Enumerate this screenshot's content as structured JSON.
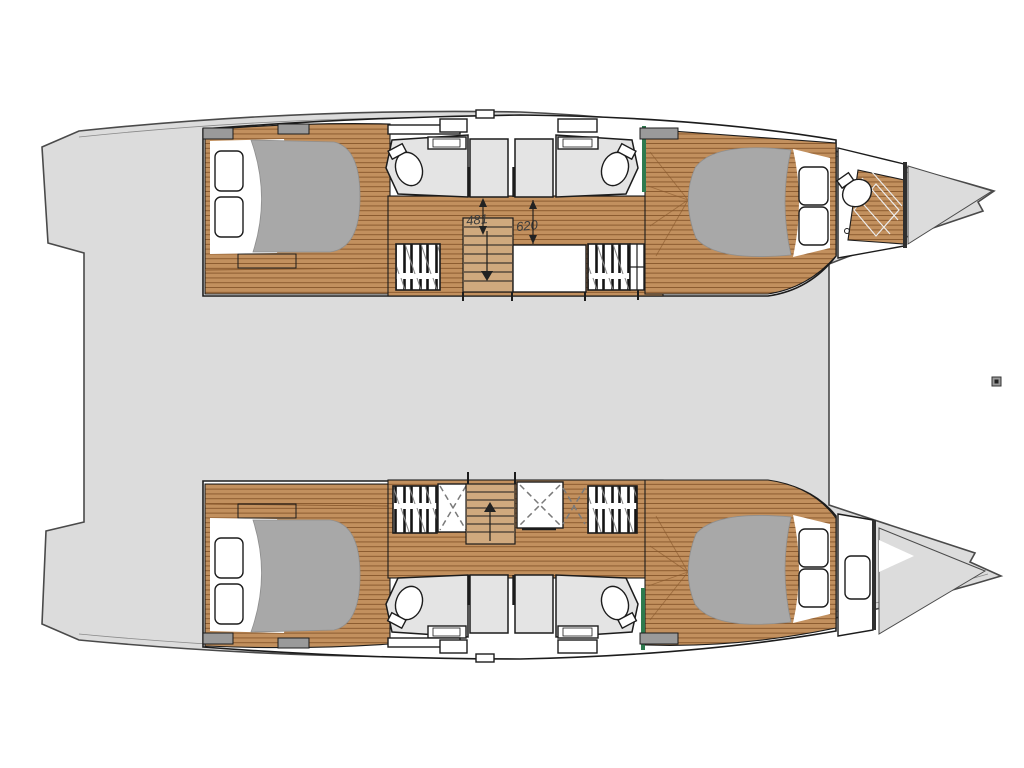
{
  "diagram": {
    "type": "boat-floor-plan",
    "subject": "catamaran deck plan, four-cabin layout with two hulls and central bridge deck",
    "annotations": {
      "dim_aft": "481",
      "dim_fwd": "620"
    }
  },
  "colors": {
    "deck": "#dcdcdc",
    "outline": "#4a4a4a",
    "line": "#1c1c1c",
    "wood": "#c2905e",
    "wood_light": "#d0a97e",
    "plank": "#8a5a2e",
    "mattress": "#a8a8a8",
    "room": "#e4e4e4",
    "green": "#2e7a4e",
    "hatch_dark": "#9a9a9a",
    "dim_text": "#3c3c3c",
    "marker": "#555555"
  }
}
